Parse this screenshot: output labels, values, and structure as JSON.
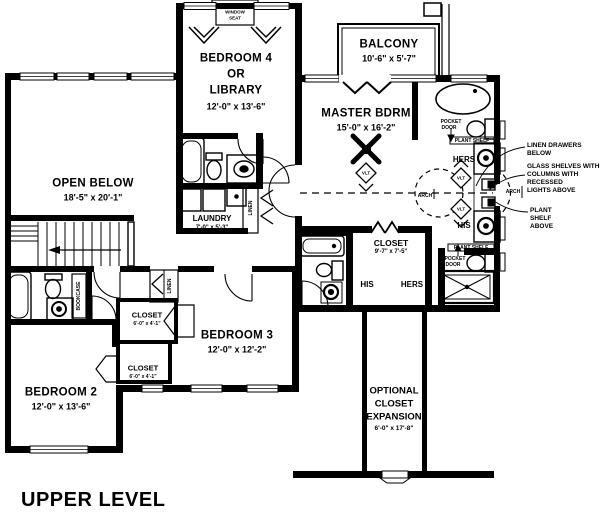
{
  "title": "UPPER LEVEL",
  "rooms": {
    "open_below": {
      "name": "OPEN BELOW",
      "dims": "18'-5\" x 20'-1\""
    },
    "bedroom4": {
      "line1": "BEDROOM 4",
      "line2": "OR",
      "line3": "LIBRARY",
      "dims": "12'-0\" x 13'-6\""
    },
    "balcony": {
      "name": "BALCONY",
      "dims": "10'-6\" x 5'-7\""
    },
    "master_bedroom": {
      "name": "MASTER BDRM",
      "dims": "15'-0\" x 16'-2\""
    },
    "laundry": {
      "name": "LAUNDRY",
      "dims": "7'-0\" x 5'-3\""
    },
    "master_closet": {
      "name": "CLOSET",
      "dims": "9'-7\" x 7'-5\""
    },
    "bedroom3": {
      "name": "BEDROOM 3",
      "dims": "12'-0\" x 12'-2\""
    },
    "bedroom2": {
      "name": "BEDROOM 2",
      "dims": "12'-0\" x 13'-6\""
    },
    "closet_bedroom3": {
      "name": "CLOSET",
      "dims": "6'-0\" x 4'-1\""
    },
    "closet_bedroom2": {
      "name": "CLOSET",
      "dims": "6'-0\" x 4'-1\""
    },
    "optional_closet": {
      "line1": "OPTIONAL",
      "line2": "CLOSET",
      "line3": "EXPANSION",
      "dims": "6'-0\" x 17'-8\""
    }
  },
  "labels": {
    "window_seat_line1": "WINDOW",
    "window_seat_line2": "SEAT",
    "pocket": "POCKET",
    "door": "DOOR",
    "plant_shelf": "PLANT SHELF",
    "hers": "HERS",
    "his": "HIS",
    "vlt": "VLT",
    "arch": "ARCH",
    "linen": "LINEN",
    "bookcase": "BOOKCASE"
  },
  "annotations": {
    "linen_drawers": {
      "line1": "LINEN DRAWERS",
      "line2": "BELOW"
    },
    "glass_shelves": {
      "line1": "GLASS SHELVES WITHIN",
      "line2": "COLUMNS WITH",
      "line3": "RECESSED",
      "line4": "LIGHTS ABOVE"
    },
    "plant_shelf_above": {
      "line1": "PLANT",
      "line2": "SHELF",
      "line3": "ABOVE"
    }
  },
  "colors": {
    "ink": "#000000",
    "paper": "#ffffff"
  }
}
